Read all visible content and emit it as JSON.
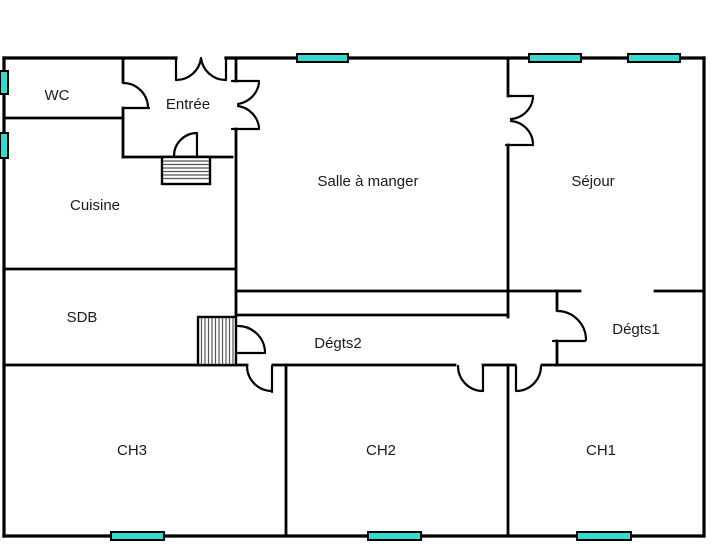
{
  "plan": {
    "name": "Plan de maison - rez-de-chaussée",
    "colors": {
      "wall": "#000000",
      "window_fill": "#36d9cc",
      "window_border": "#000000",
      "label": "#1a1a1a",
      "hatch": "#444444",
      "background": "#ffffff"
    },
    "rooms": [
      {
        "id": "wc",
        "label": "WC",
        "cx": 57,
        "cy": 100
      },
      {
        "id": "entree",
        "label": "Entrée",
        "cx": 188,
        "cy": 109
      },
      {
        "id": "cuisine",
        "label": "Cuisine",
        "cx": 95,
        "cy": 210
      },
      {
        "id": "salle-a-manger",
        "label": "Salle à manger",
        "cx": 368,
        "cy": 186
      },
      {
        "id": "sejour",
        "label": "Séjour",
        "cx": 593,
        "cy": 186
      },
      {
        "id": "sdb",
        "label": "SDB",
        "cx": 82,
        "cy": 322
      },
      {
        "id": "degts2",
        "label": "Dégts2",
        "cx": 338,
        "cy": 348
      },
      {
        "id": "degts1",
        "label": "Dégts1",
        "cx": 636,
        "cy": 334
      },
      {
        "id": "ch3",
        "label": "CH3",
        "cx": 132,
        "cy": 455
      },
      {
        "id": "ch2",
        "label": "CH2",
        "cx": 381,
        "cy": 455
      },
      {
        "id": "ch1",
        "label": "CH1",
        "cx": 601,
        "cy": 455
      }
    ],
    "windows": [
      {
        "id": "window-salle-a-manger",
        "x": 297,
        "y": 54,
        "w": 51,
        "h": 8
      },
      {
        "id": "window-sejour-1",
        "x": 529,
        "y": 54,
        "w": 52,
        "h": 8
      },
      {
        "id": "window-sejour-2",
        "x": 628,
        "y": 54,
        "w": 52,
        "h": 8
      },
      {
        "id": "window-wc",
        "x": 0,
        "y": 71,
        "w": 8,
        "h": 23
      },
      {
        "id": "window-cuisine",
        "x": 0,
        "y": 133,
        "w": 8,
        "h": 25
      },
      {
        "id": "window-ch3",
        "x": 111,
        "y": 532,
        "w": 53,
        "h": 8
      },
      {
        "id": "window-ch2",
        "x": 368,
        "y": 532,
        "w": 53,
        "h": 8
      },
      {
        "id": "window-ch1",
        "x": 577,
        "y": 532,
        "w": 54,
        "h": 8
      }
    ]
  }
}
